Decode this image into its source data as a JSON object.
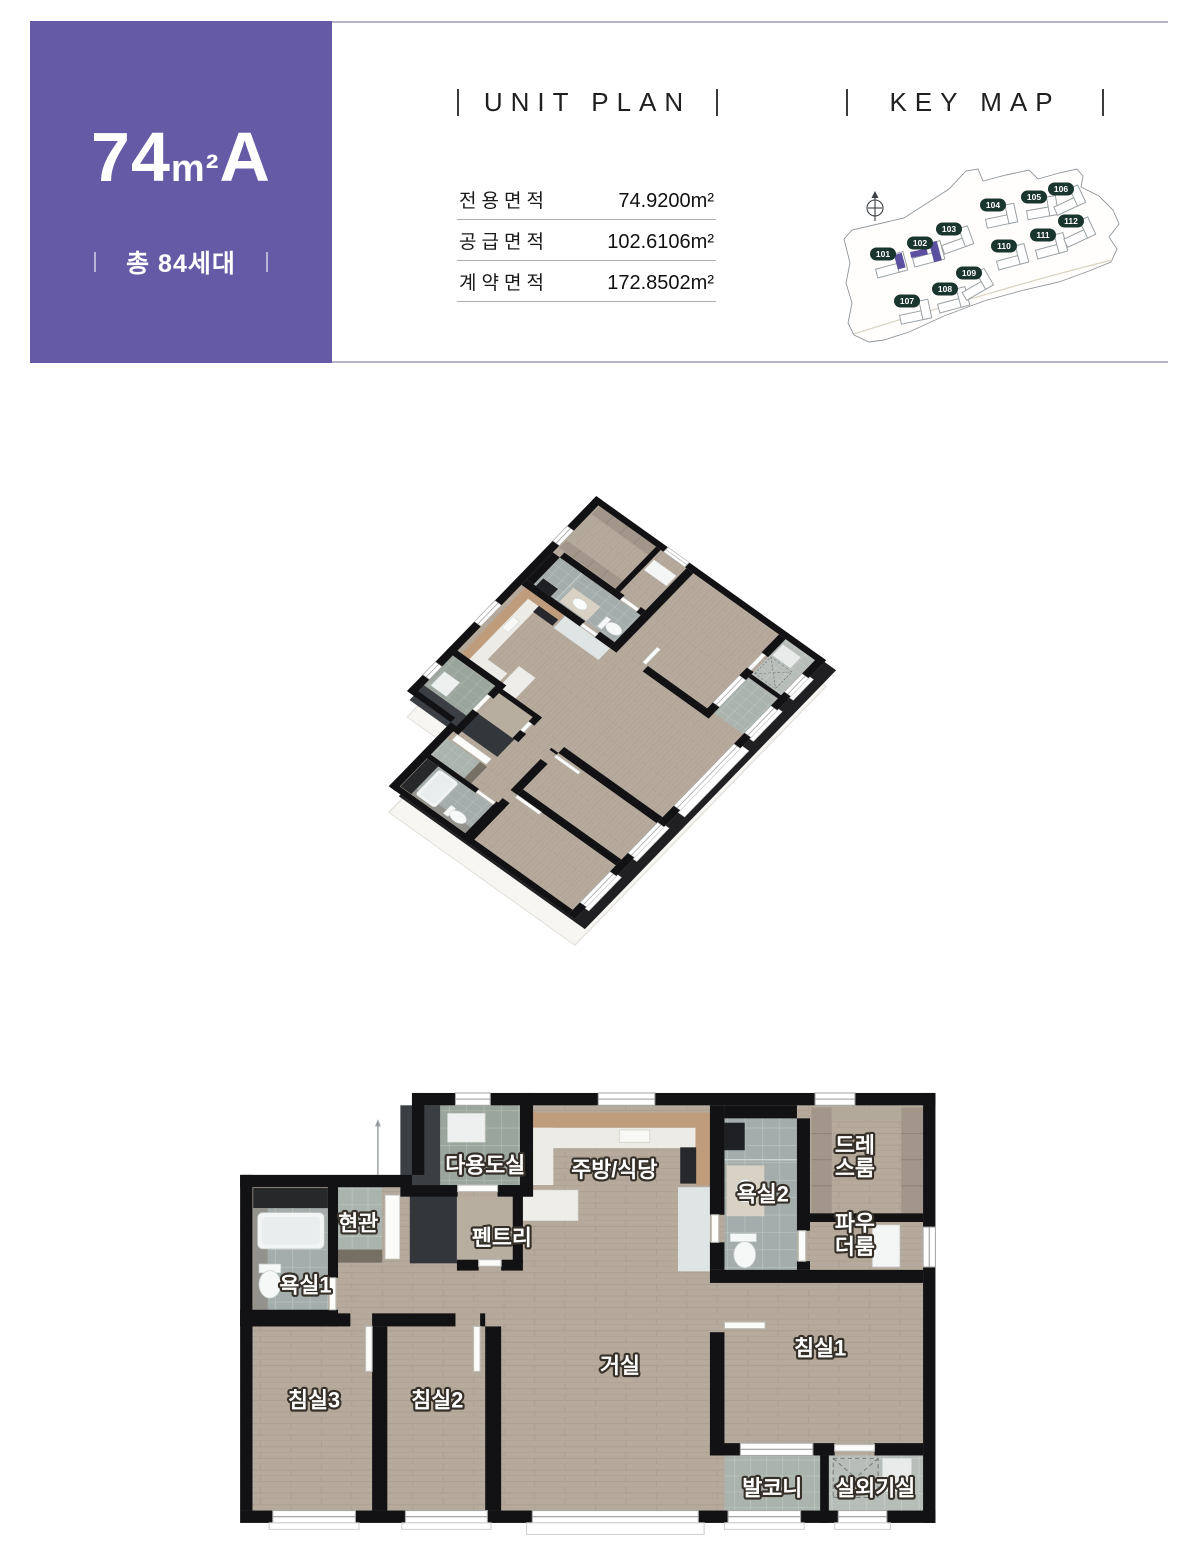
{
  "unit_header": {
    "badge": {
      "size_main": "74",
      "size_unit": "m²",
      "size_type": "A",
      "total": "총 84세대",
      "bg": "#655aa6"
    },
    "unit_plan": {
      "title": "UNIT PLAN",
      "areas": [
        {
          "label": "전용면적",
          "value": "74.9200m²"
        },
        {
          "label": "공급면적",
          "value": "102.6106m²"
        },
        {
          "label": "계약면적",
          "value": "172.8502m²"
        }
      ]
    },
    "key_map": {
      "title": "KEY MAP",
      "compass": "N",
      "badge_color": "#1a342e",
      "highlight_color": "#5b50a0",
      "buildings": [
        {
          "id": "101",
          "x": 853,
          "y": 231,
          "rot": -15
        },
        {
          "id": "102",
          "x": 890,
          "y": 220,
          "rot": -15
        },
        {
          "id": "103",
          "x": 919,
          "y": 206,
          "rot": -20
        },
        {
          "id": "104",
          "x": 963,
          "y": 182,
          "rot": -12
        },
        {
          "id": "105",
          "x": 1004,
          "y": 174,
          "rot": -10
        },
        {
          "id": "106",
          "x": 1031,
          "y": 166,
          "rot": -25
        },
        {
          "id": "107",
          "x": 877,
          "y": 278,
          "rot": -12
        },
        {
          "id": "108",
          "x": 915,
          "y": 266,
          "rot": -15
        },
        {
          "id": "109",
          "x": 939,
          "y": 250,
          "rot": -30
        },
        {
          "id": "110",
          "x": 974,
          "y": 223,
          "rot": -15
        },
        {
          "id": "111",
          "x": 1013,
          "y": 212,
          "rot": -15
        },
        {
          "id": "112",
          "x": 1041,
          "y": 198,
          "rot": -25
        }
      ],
      "highlights": [
        {
          "x": 864,
          "y": 232,
          "w": 8,
          "h": 15,
          "rot": -15
        },
        {
          "x": 880,
          "y": 229,
          "w": 17,
          "h": 6,
          "rot": -12
        },
        {
          "x": 899,
          "y": 220,
          "w": 8,
          "h": 20,
          "rot": -15
        }
      ]
    }
  },
  "floor_plan": {
    "wall_color": "#121215",
    "rooms": [
      {
        "key": "utility",
        "lines": [
          "다용도실"
        ],
        "x": 338,
        "y": 100
      },
      {
        "key": "kitchen-dining",
        "lines": [
          "주방/식당"
        ],
        "x": 516,
        "y": 106
      },
      {
        "key": "entrance",
        "lines": [
          "현관"
        ],
        "x": 163,
        "y": 180
      },
      {
        "key": "pantry",
        "lines": [
          "펜트리"
        ],
        "x": 361,
        "y": 200
      },
      {
        "key": "bath1",
        "lines": [
          "욕실1"
        ],
        "x": 90,
        "y": 265
      },
      {
        "key": "bath2",
        "lines": [
          "욕실2"
        ],
        "x": 721,
        "y": 140
      },
      {
        "key": "dress-room",
        "lines": [
          "드레",
          "스룸"
        ],
        "x": 848,
        "y": 88
      },
      {
        "key": "powder-room",
        "lines": [
          "파우",
          "더룸"
        ],
        "x": 848,
        "y": 196
      },
      {
        "key": "bedroom3",
        "lines": [
          "침실3"
        ],
        "x": 102,
        "y": 424
      },
      {
        "key": "bedroom2",
        "lines": [
          "침실2"
        ],
        "x": 272,
        "y": 424
      },
      {
        "key": "living-room",
        "lines": [
          "거실"
        ],
        "x": 524,
        "y": 376
      },
      {
        "key": "bedroom1",
        "lines": [
          "침실1"
        ],
        "x": 800,
        "y": 352
      },
      {
        "key": "balcony",
        "lines": [
          "발코니"
        ],
        "x": 734,
        "y": 545
      },
      {
        "key": "ac-room",
        "lines": [
          "실외기실"
        ],
        "x": 876,
        "y": 545
      }
    ]
  }
}
